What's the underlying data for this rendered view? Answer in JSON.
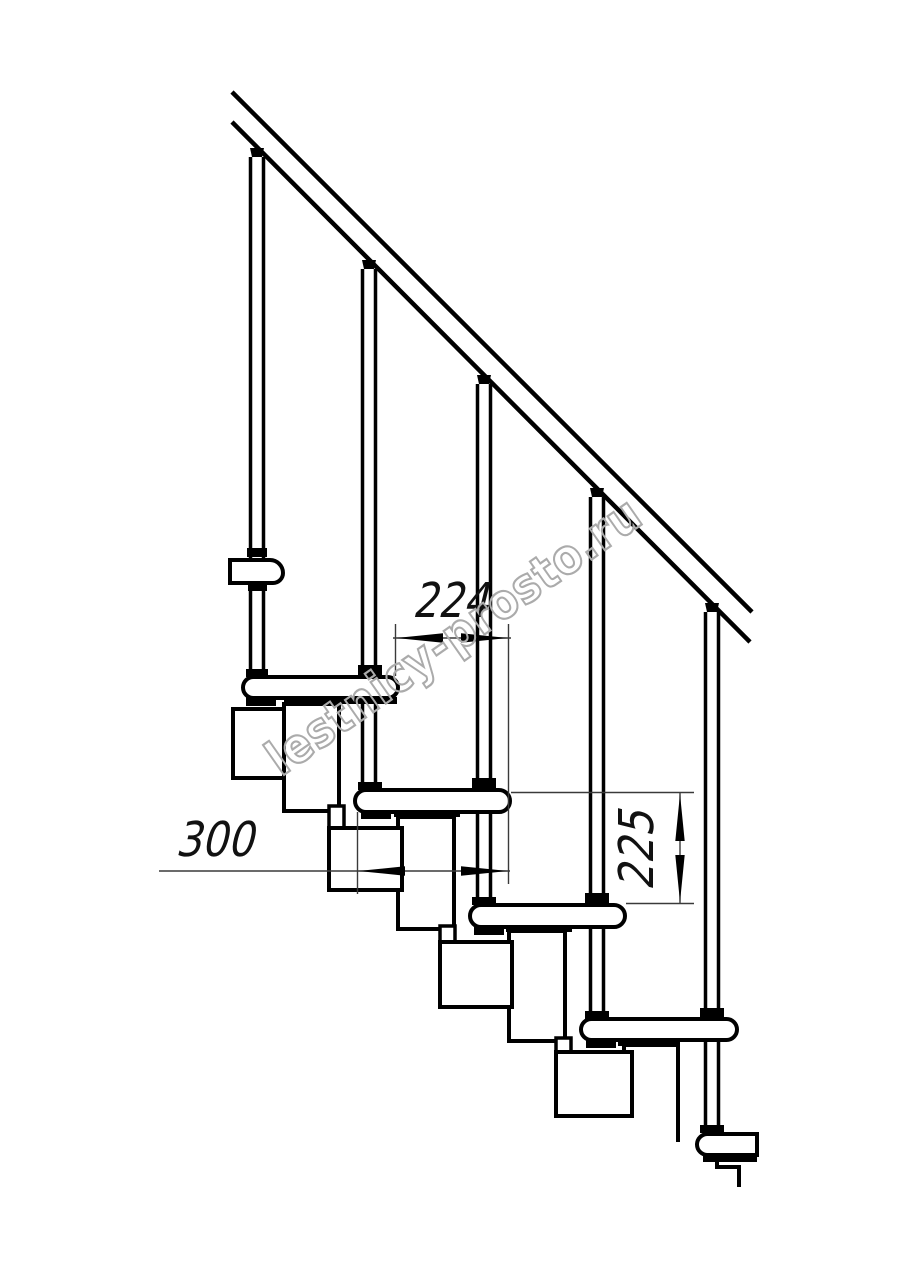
{
  "drawing": {
    "kind": "modular staircase side elevation drawing",
    "treads_visible": 4,
    "balusters_visible": 5,
    "has_handrail": true
  },
  "dimensions": {
    "step_run": {
      "value": "224",
      "orientation": "horizontal"
    },
    "tread_depth": {
      "value": "300",
      "orientation": "horizontal"
    },
    "riser_height": {
      "value": "225",
      "orientation": "vertical"
    }
  },
  "watermark": {
    "text": "lestnicy-prosto.ru"
  },
  "colors": {
    "background": "#ffffff",
    "ink": "#000000",
    "dimension_line": "#3a3a3a",
    "dimension_text": "#111111",
    "watermark": "#ababab"
  }
}
